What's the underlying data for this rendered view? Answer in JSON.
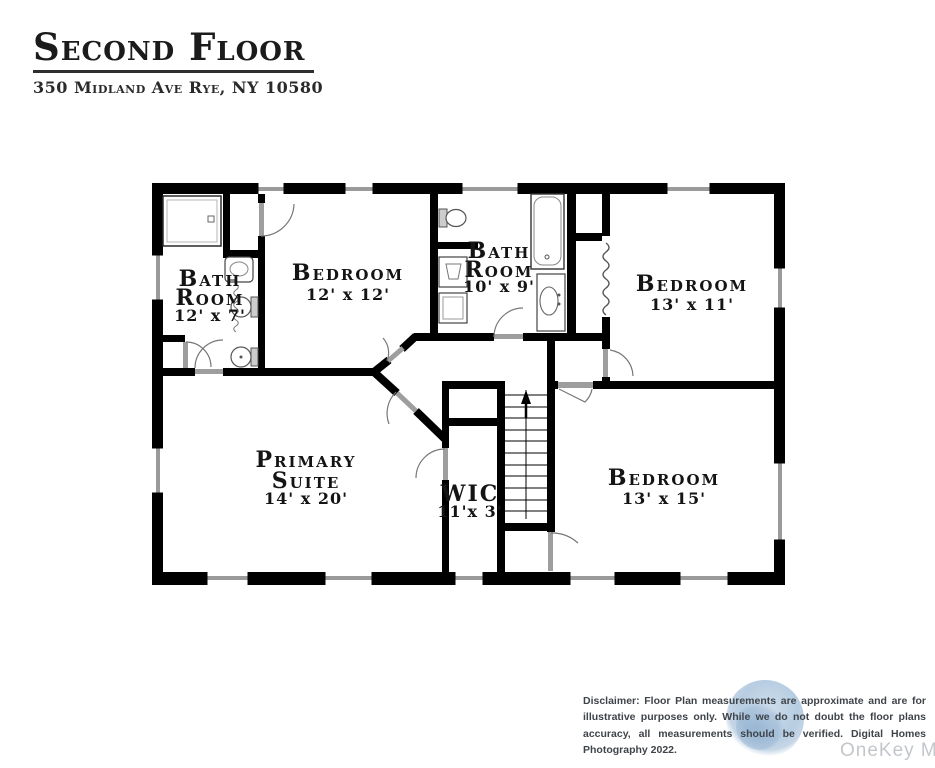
{
  "header": {
    "title": "Second Floor",
    "subtitle": "350 Midland Ave Rye, NY 10580"
  },
  "plan": {
    "rooms": {
      "bath_left": {
        "line1": "Bath",
        "line2": "Room",
        "dims": "12' x 7'"
      },
      "bedroom_12x12": {
        "line1": "Bedroom",
        "dims": "12' x 12'"
      },
      "bath_mid": {
        "line1": "Bath",
        "line2": "Room",
        "dims": "10' x 9'"
      },
      "bedroom_13x11": {
        "line1": "Bedroom",
        "dims": "13' x 11'"
      },
      "primary_suite": {
        "line1": "Primary",
        "line2": "Suite",
        "dims": "14' x 20'"
      },
      "wic": {
        "line1": "WIC",
        "dims": "11'x 3'"
      },
      "bedroom_13x15": {
        "line1": "Bedroom",
        "dims": "13' x 15'"
      }
    }
  },
  "footer": {
    "disclaimer": "Disclaimer: Floor Plan measurements are approximate and are for illustrative purposes only. While we do not doubt the floor plans accuracy, all measurements should be verified. Digital Homes Photography 2022.",
    "watermark": "OneKey MLS"
  },
  "colors": {
    "wall": "#000000",
    "door_leaf": "#9e9e9e",
    "window": "#9a9a9a",
    "watermark_blue": "#aac4da",
    "watermark_text": "#c3c7cb"
  }
}
